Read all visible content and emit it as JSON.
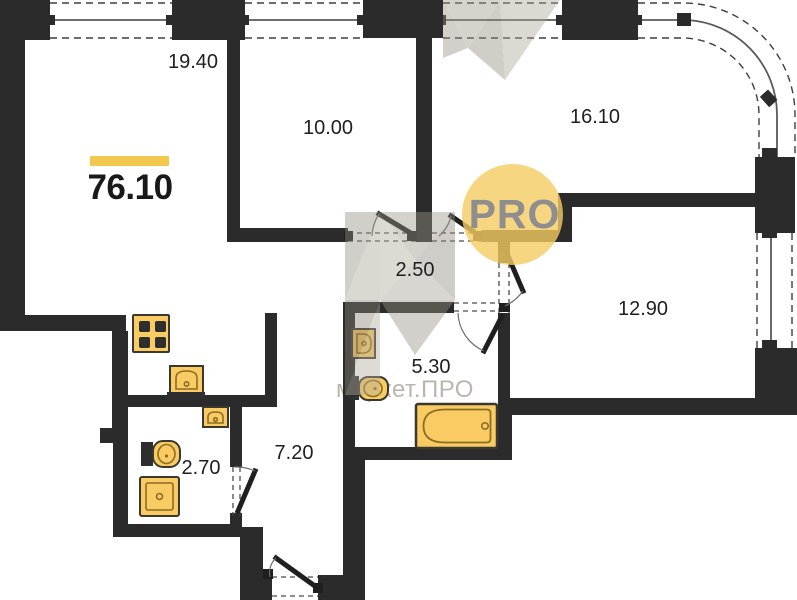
{
  "total_area": {
    "value": "76.10"
  },
  "rooms": {
    "living": "19.40",
    "room_top": "10.00",
    "room_right": "16.10",
    "hall_inner": "2.50",
    "room_bottom": "12.90",
    "bathroom": "5.30",
    "wc": "2.70",
    "hallway": "7.20"
  },
  "branding": {
    "logo_text": "PRO",
    "watermark_text": "маркет.ПРО"
  },
  "colors": {
    "wall": "#2b2b2b",
    "fixture_fill": "#F9CB62",
    "accent_bar": "#F3C84E",
    "pro_circle": "#F4CC61",
    "pro_text": "#8e8e8e",
    "label_text": "#1f1f1f",
    "watermark": "#8d857a"
  }
}
